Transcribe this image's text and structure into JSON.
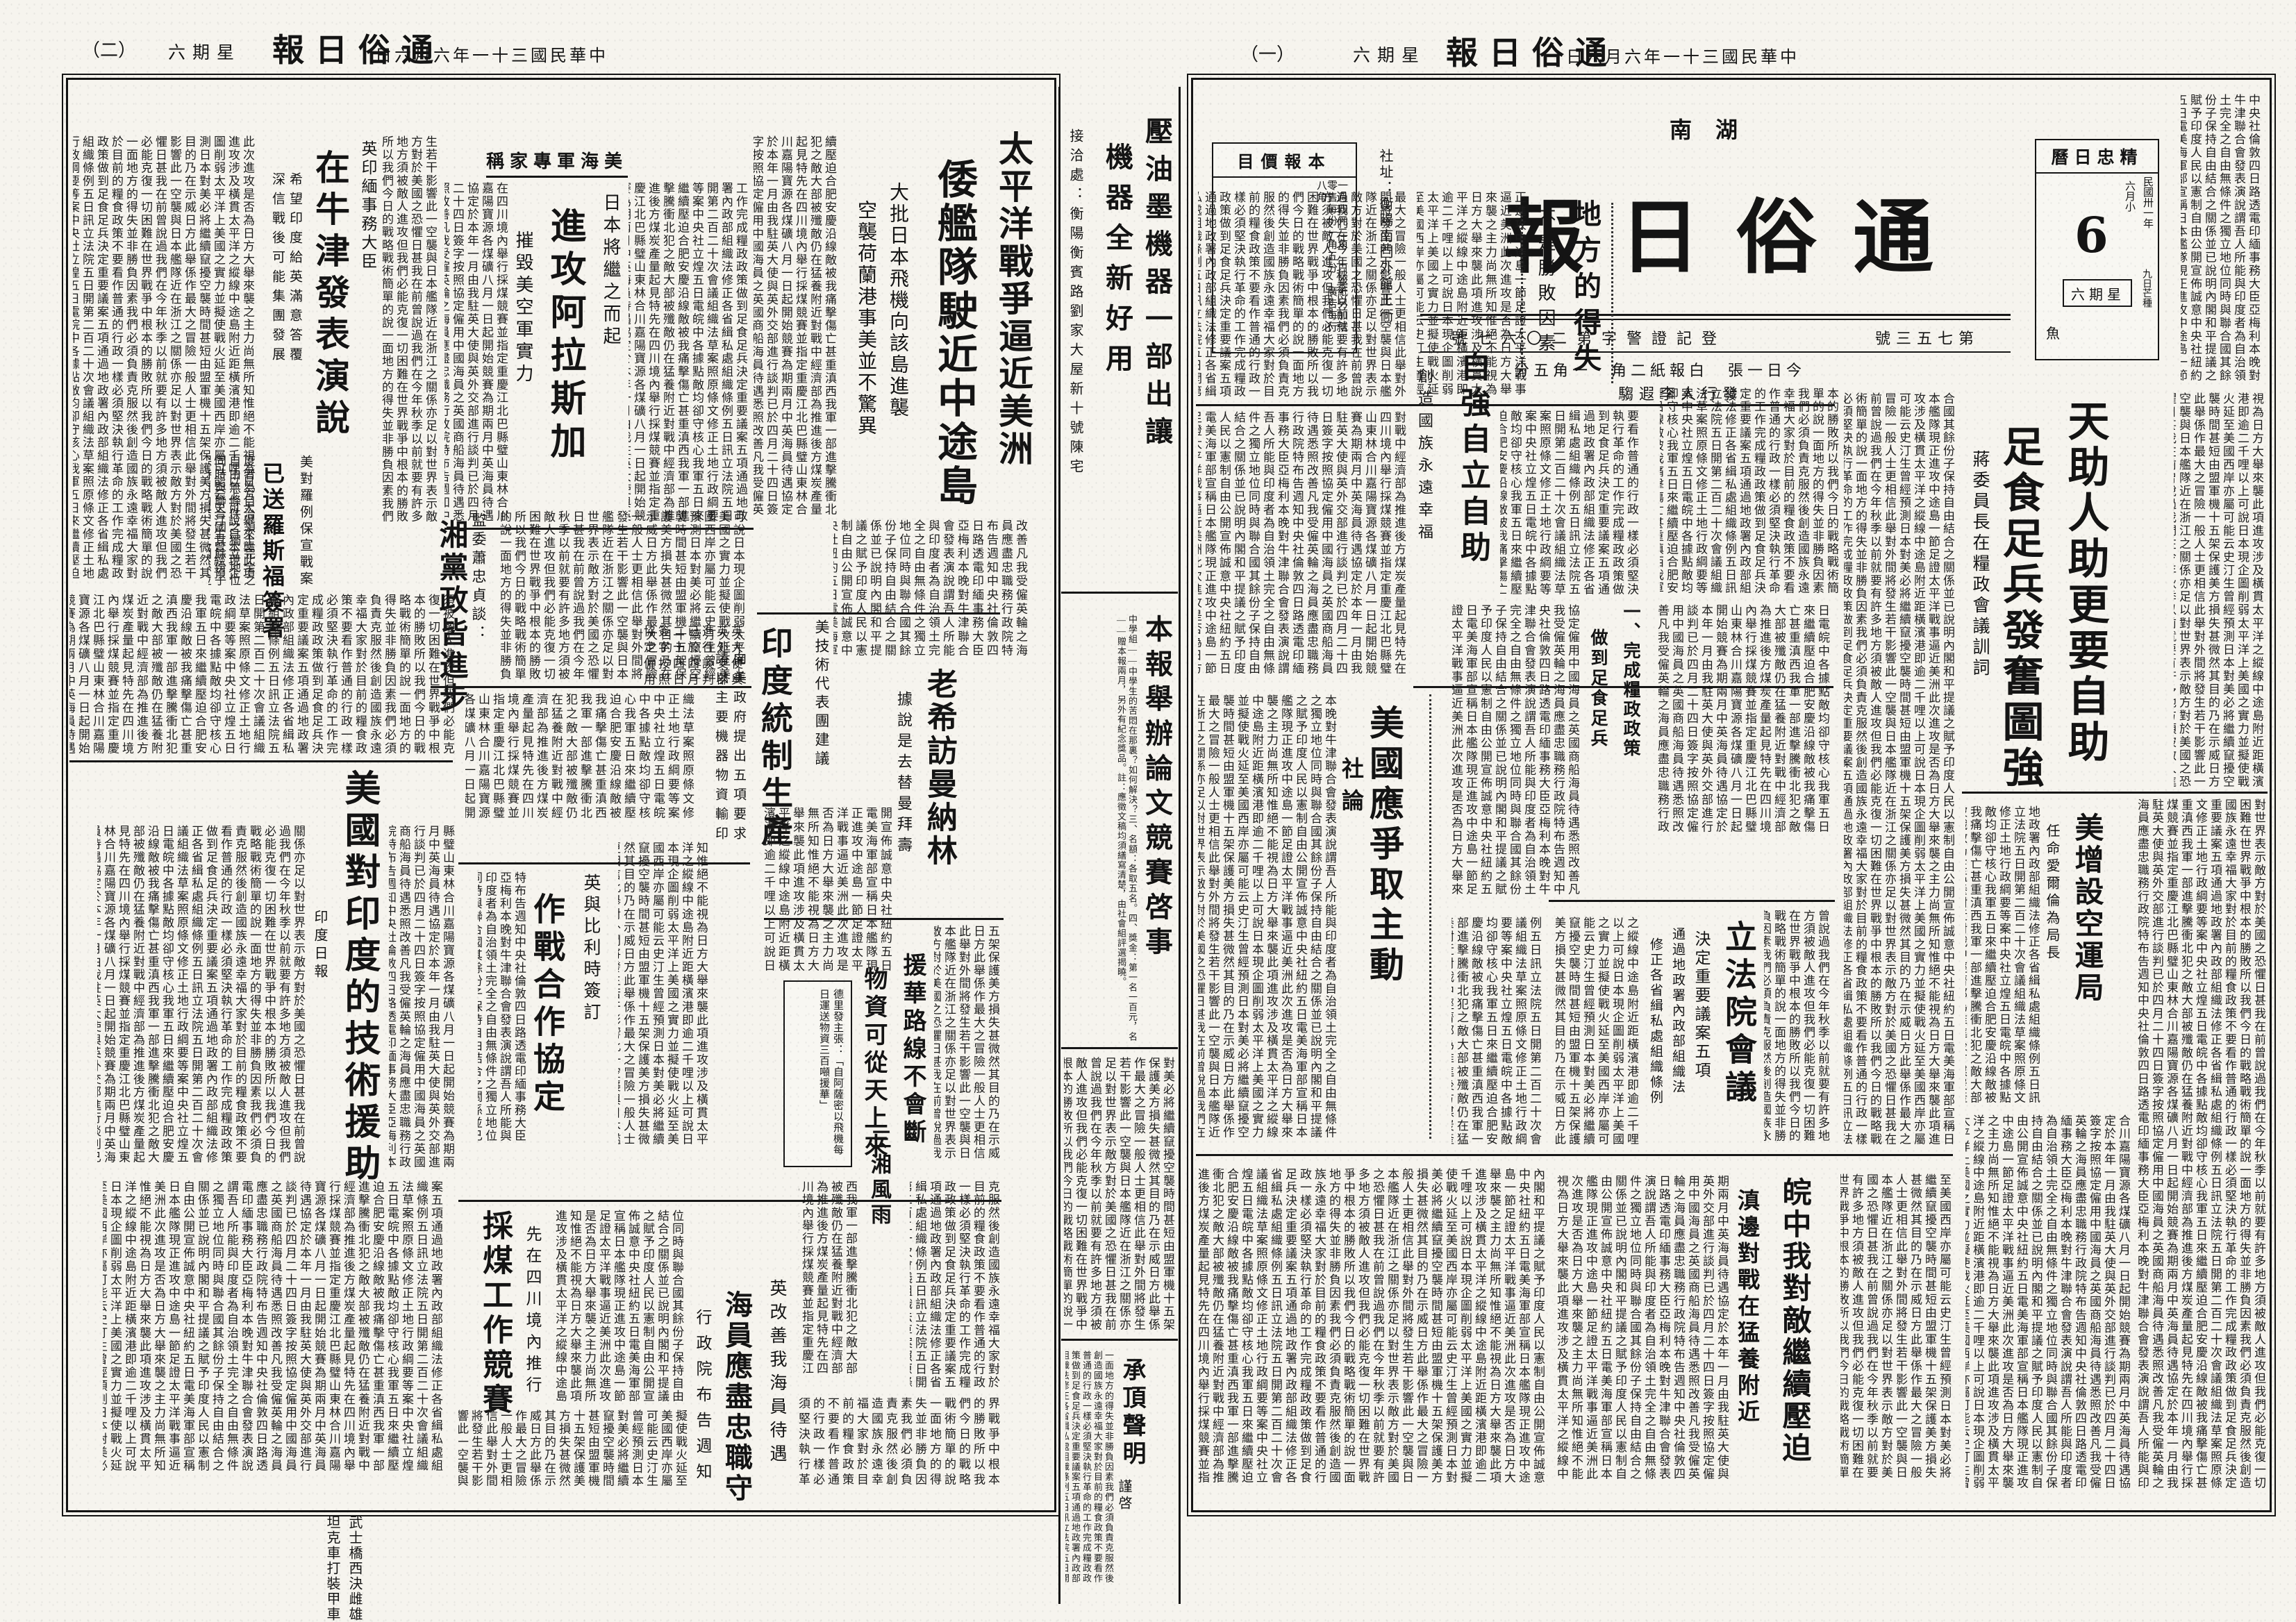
{
  "paper": {
    "name": "通俗日報",
    "name_display": "報日俗通",
    "region_display": "南湖",
    "date_display": "日六月六年一十三國民華中",
    "weekday_display": "六期星",
    "page1_label": "（一）",
    "page2_label": "（二）",
    "address": "社址：衡陽南門外館王衕",
    "registration_display": "號七六〇二第字警證記登",
    "issue_display": "號三五七第",
    "price_line_display": "分五角一　角二紙報白　張一日今",
    "publisher_display": "騶遐李人行發"
  },
  "pricebox": {
    "title_display": "目價報本",
    "lines": "一月四元二角　白報紙另加倍　零售每份一角五分　廣告每行八角"
  },
  "calendar": {
    "title_display": "曆日忠精",
    "year": "民國卅一年",
    "month": "六月小",
    "day": "6",
    "weekday_display": "六期星",
    "term": "九日芒種",
    "zodiac": "魚"
  },
  "page1": {
    "xunci_kicker": "蔣委員長在糧政會議訓詞",
    "xunci_t1": "天助人助更要自助",
    "xunci_t2": "足食足兵發奮圖強",
    "xunci_sub1": "一、完成糧政政策",
    "xunci_sub2": "做到足食足兵",
    "difang_t": "地方的得失",
    "difang_sub": "不是勝敗因素",
    "ziqiang_t": "自強自立自助",
    "ziqiang_sub": "創造國族永遠幸福",
    "shelun_label": "社論",
    "shelun_t": "美國應爭取主動",
    "kongyun_t": "美增設空運局",
    "kongyun_sub": "任命愛爾倫為局長",
    "lifa_t": "立法院會議",
    "lifa_sub1": "決定重要議案五項",
    "lifa_sub2": "通過地政署內政部組織法",
    "lifa_sub3": "修正各省緝私處組織條例",
    "wan_t1": "皖中我對敵繼續壓迫",
    "wan_t2": "滇邊對戰在猛養附近"
  },
  "page2": {
    "tpy_t1": "太平洋戰爭逼近美洲",
    "tpy_t2": "倭艦隊駛近中途島",
    "tpy_sub1": "大批日本飛機向該島進襲",
    "tpy_sub2": "空襲荷蘭港事美並不驚異",
    "nj_kicker": "英印緬事務大臣",
    "nj_t": "在牛津發表演說",
    "nj_sub1": "希望印度給英滿意答覆",
    "nj_sub2": "深信戰後可能集團發展",
    "alsj_kicker_display": "稱家專軍海美",
    "alsj_sub1": "日本將繼之而起",
    "alsj_t": "進攻阿拉斯加",
    "alsj_sub2": "摧毀美空軍實力",
    "xz_kicker": "美對羅例保宣戰案",
    "xz_t": "已送羅斯福簽署",
    "xd_kicker": "監委蕭忠貞談：",
    "xd_t": "湘黨政皆進步",
    "yd_kicker": "美技術代表團建議",
    "yd_t": "印度統制生產",
    "yd_sub1": "向美政府提出五項要求",
    "yd_sub2": "請以主要機器物資輸印",
    "lx_t": "老希訪曼納林",
    "lx_sub": "據說是去替曼拜壽",
    "yh_t1": "援華路線不會斷",
    "yh_t2": "物資可從天上來",
    "yh_box": "德里發主張：「自阿薩密以飛機每日運送物資三百噸援華」",
    "zz_kicker": "英與比利時簽訂",
    "zz_t": "作戰合作協定",
    "js_t": "美國對印度的技術援助",
    "js_source": "印度日報",
    "cm_t": "採煤工作競賽",
    "cm_sub": "先在四川境內推行",
    "hy_kicker": "英改善我海員待遇",
    "hy_t": "海員應盡忠職守",
    "hy_sub": "行政院布告週知",
    "sx_t": "三湘風雨",
    "ws_l1": "武士橋西決雌雄",
    "ws_l2": "坦克車打裝甲車"
  },
  "center": {
    "ad_t1": "壓油墨機器一部出讓",
    "ad_t2": "機器全新好用",
    "ad_contact": "接洽處：衡陽衡賓路劉家大屋新十號陳宅",
    "notice_t": "本報舉辦論文競賽啓事",
    "notice_body": "中學組——中學生的苦悶在那裏？如何解決？三、名額：各取五名。四、獎金：第一名一百元，名——贈本報兩月，另外有紀念獎品。註：應徵文稿均須繕寫清楚，由社會組評選揭曉。",
    "cd_t": "承頂聲明",
    "cd_sign": "謹啓"
  },
  "filler": "中央社倫敦四日路透電印緬事務大臣亞梅利本晚對牛津聯合會發表演說謂吾人所能與印度者為自治領土完全之自由無條件之獨立地位同時與聯合國其餘份子保持自由結合之關係並已說明內閣和平提議之賦予印度人民以憲制自由公開宣佈誠意中央社紐約五日電美海軍部宣稱日本艦隊現正進攻中途島一節足證太平洋戰事逼近美洲此次進攻是否為日方大舉來襲之主力尚無所知惟絕不能視為日方大舉來襲此項進攻涉及橫貫太平洋之縱線中途島附近距橫濱港即逾二千哩以上可說日本現企圖削弱太平洋上美國之實力並擬使戰火延至美國西岸亦屬可能云史汀生曾經預測日本對美必將繼續竄擾空襲時間甚短由盟軍機十五架保護美方損失甚微然其目的乃在示威日方此舉係作最大之冒險一般人士更相信此舉對外間將發生若干影響此一空襲與日本艦隊近在浙江之關係亦足以對世界表示敵方對於美國之恐懼日甚我在前曾說過我們在今年秋季以前就要有許多地方須被敵人進攻但我們必能克復一切困難在世界戰爭中根本的勝敗所以我們今日的戰略戰術簡單的說一面地方的得失並非勝負因素我們必須負責克服然後創造國族永遠幸福大家對於目前的糧食政策不要看作普通的行政一樣必須堅決執行革命的工作完成糧政政策做到足食足兵決定重要議案五項通過地政署內政部組織法修正各省緝私處組織條例五日訊立法院五日開第二百二十次會議組織法草案照原條文修正土地行政綱要等案中央社立煌五日電皖中各據點敵均卻守核心我軍五日來繼續壓迫合肥安慶沿線敵被我痛擊傷亡甚重滇西我軍一部進擊騰衝北犯之敵大部被殲敵仍在猛養附近對戰中經濟部為推進後方煤炭產量起見特先在四川境內舉行採煤競賽並指定重慶江北巴縣璧山東林合川嘉陽寶源各煤礦八月一日起開始競賽為期兩月中英海員待遇協定於本年一月由我駐英大使與英外交部進行談判已於四月二十四日簽字按照協定僱用中國海員之英國商船海員待遇悉照改善凡我受僱英輪之海員應盡忠職務行政院特布告週知"
}
